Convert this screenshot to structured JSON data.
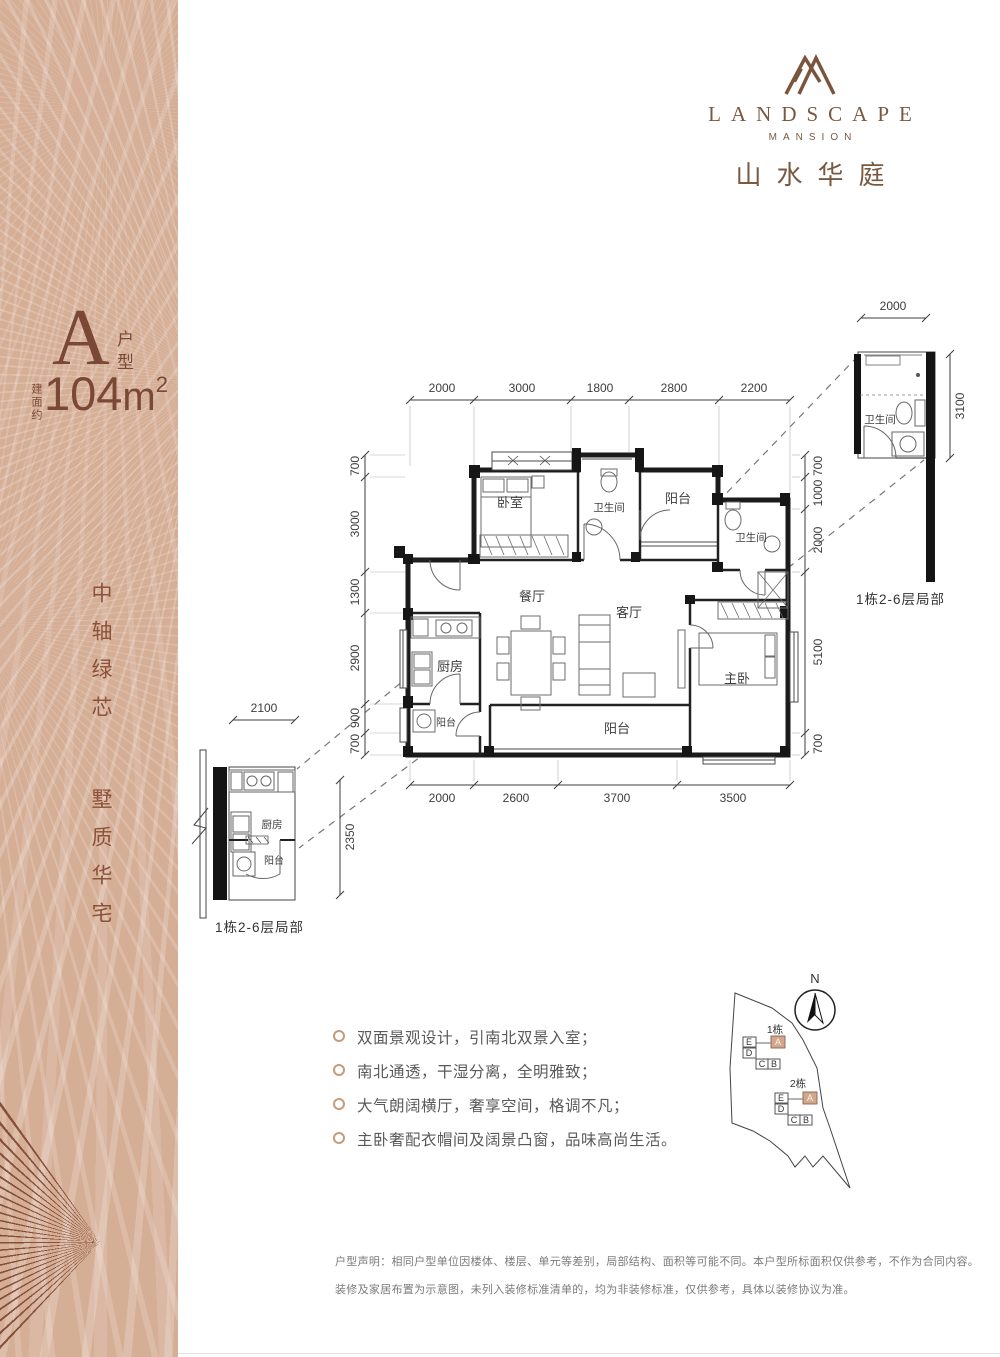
{
  "brand": {
    "en": "LANDSCAPE",
    "sub": "MANSION",
    "cn": "山水华庭"
  },
  "unit": {
    "type_letter": "A",
    "type_suffix_1": "户",
    "type_suffix_2": "型",
    "area_prefix": "建面约",
    "area_number": "104",
    "area_unit": "m",
    "area_exponent": "2"
  },
  "slogan": {
    "line1": "中轴绿芯",
    "line2": "墅质华宅"
  },
  "floorplan": {
    "rooms": {
      "bedroom": "卧室",
      "bath_top": "卫生间",
      "balcony_north": "阳台",
      "bath_right": "卫生间",
      "dining": "餐厅",
      "living": "客厅",
      "kitchen": "厨房",
      "kitchen_balcony": "阳台",
      "balcony_south": "阳台",
      "master": "主卧"
    },
    "dims_top": [
      "2000",
      "3000",
      "1800",
      "2800",
      "2200"
    ],
    "dims_bottom": [
      "2000",
      "2600",
      "3700",
      "3500"
    ],
    "dims_left": [
      "700",
      "3000",
      "1300",
      "2900",
      "900",
      "700"
    ],
    "dims_right": [
      "700",
      "1000",
      "2000",
      "5100",
      "700"
    ]
  },
  "detail_bath": {
    "caption": "1栋2-6层局部",
    "room": "卫生间",
    "dim_w": "2000",
    "dim_h": "3100"
  },
  "detail_kitchen": {
    "caption": "1栋2-6层局部",
    "room": "厨房",
    "balcony": "阳台",
    "dim_w": "2100",
    "dim_h": "2350"
  },
  "features": [
    "双面景观设计，引南北双景入室；",
    "南北通透，干湿分离，全明雅致；",
    "大气朗阔横厅，奢享空间，格调不凡；",
    "主卧奢配衣帽间及阔景凸窗，品味高尚生活。"
  ],
  "siteplan": {
    "north_label": "N",
    "cluster1_label": "1栋",
    "cluster2_label": "2栋",
    "letters": {
      "a": "A",
      "b": "B",
      "c": "C",
      "d": "D",
      "e": "E"
    }
  },
  "disclaimer": {
    "line1": "户型声明：相同户型单位因楼体、楼层、单元等差别，局部结构、面积等可能不同。本户型所标面积仅供参考，不作为合同内容。",
    "line2": "装修及家居布置为示意图，未列入装修标准清单的，均为非装修标准，仅供参考，具体以装修协议为准。"
  },
  "colors": {
    "accent": "#7c4836",
    "bronze": "#7a5941",
    "sidebar": "#d5ae96",
    "highlight": "#d3a78c"
  }
}
